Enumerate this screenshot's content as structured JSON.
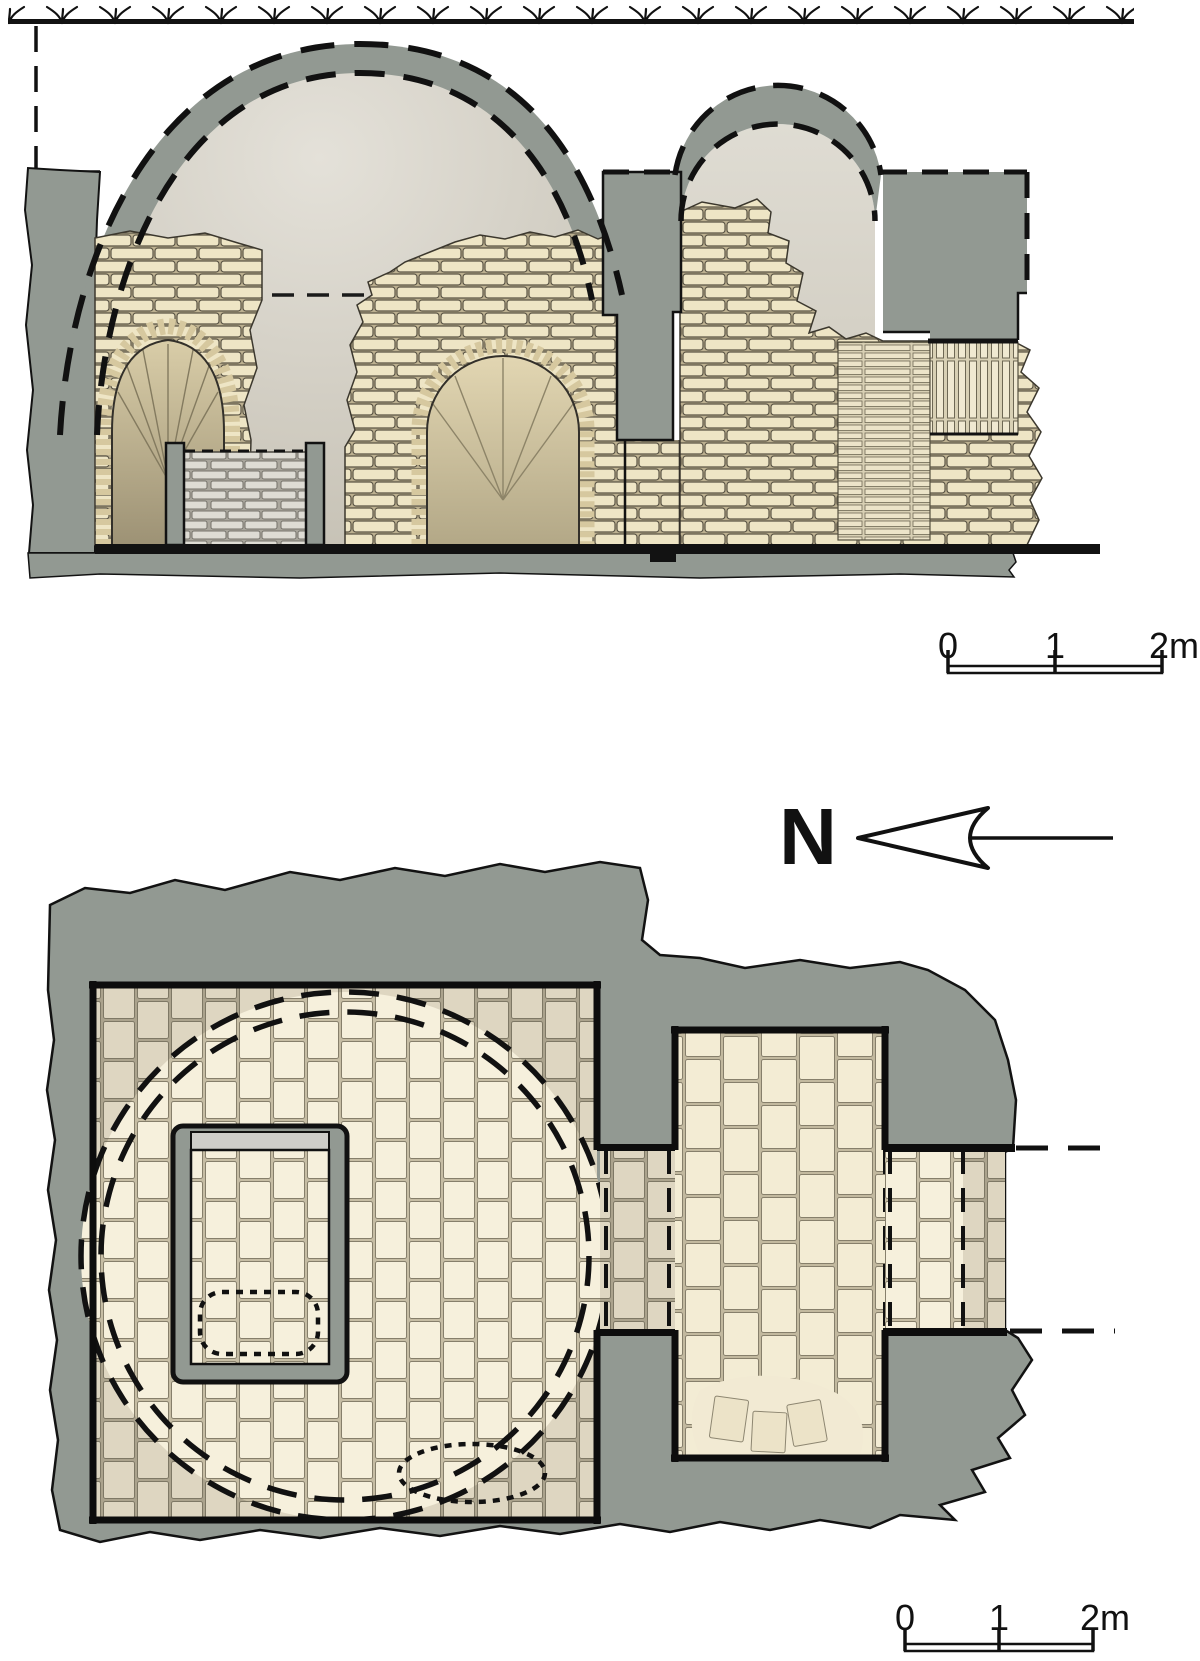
{
  "section": {
    "scale_bar": {
      "labels": [
        "0",
        "1",
        "2m"
      ]
    }
  },
  "plan": {
    "north_label": "N",
    "scale_bar": {
      "labels": [
        "0",
        "1",
        "2m"
      ]
    }
  },
  "colors": {
    "wall_gray": "#929992",
    "outline": "#121212",
    "brick_fill": "#eee5c5",
    "brick_joint": "#bcb090",
    "brick_line": "#5a5444",
    "grave_brick": "#dedcd4",
    "grave_joint": "#a9a69c",
    "paving_light": "#f6f0dc",
    "paving_light_joint": "#c6bda4",
    "paving_dark": "#ded6c1",
    "paving_dark_joint": "#aba38d",
    "paving_stroke": "#867f6b",
    "interior_top": "#e4e1d9",
    "interior_bottom": "#c3beb1",
    "vault_top": "#dfdcd3",
    "vault_bottom": "#cac5b8",
    "niche_top": "#d9cda8",
    "niche_bottom": "#9d9275",
    "voussoir": "#d6c89f",
    "lintel_gray": "#cecdc9",
    "white": "#ffffff"
  }
}
